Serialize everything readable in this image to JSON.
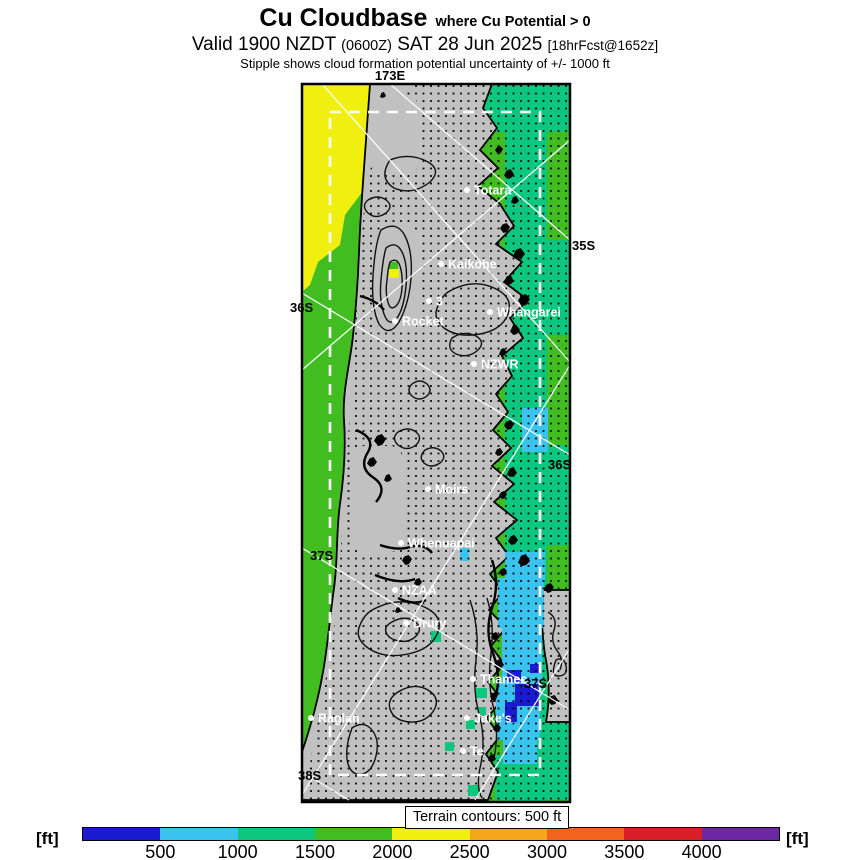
{
  "header": {
    "title": "Cu Cloudbase",
    "title_qualifier": "where Cu Potential > 0",
    "valid_prefix": "Valid 1900 NZDT",
    "valid_utc": "(0600Z)",
    "valid_date": "SAT 28 Jun 2025",
    "forecast_ref": "[18hrFcst@1652z]",
    "stipple_note": "Stipple shows cloud formation potential uncertainty of +/- 1000 ft"
  },
  "map": {
    "grid_labels": [
      {
        "text": "173E",
        "x": 390,
        "y": 80,
        "anchor": "middle"
      },
      {
        "text": "35S",
        "x": 572,
        "y": 250,
        "anchor": "start"
      },
      {
        "text": "36S",
        "x": 290,
        "y": 312,
        "anchor": "start"
      },
      {
        "text": "36S",
        "x": 548,
        "y": 469,
        "anchor": "start"
      },
      {
        "text": "37S",
        "x": 310,
        "y": 560,
        "anchor": "start"
      },
      {
        "text": "37S",
        "x": 524,
        "y": 688,
        "anchor": "start"
      },
      {
        "text": "38S",
        "x": 298,
        "y": 780,
        "anchor": "start"
      }
    ],
    "places": [
      {
        "name": "Totara",
        "x": 467,
        "y": 190
      },
      {
        "name": "Kaikohe",
        "x": 441,
        "y": 264
      },
      {
        "name": "3",
        "x": 429,
        "y": 301
      },
      {
        "name": "Rocket",
        "x": 395,
        "y": 321
      },
      {
        "name": "Whangarei",
        "x": 490,
        "y": 312
      },
      {
        "name": "NZWR",
        "x": 474,
        "y": 364
      },
      {
        "name": "Moirs",
        "x": 428,
        "y": 489
      },
      {
        "name": "Whenuapai",
        "x": 401,
        "y": 543
      },
      {
        "name": "NZAA",
        "x": 395,
        "y": 590
      },
      {
        "name": "Drury",
        "x": 406,
        "y": 623
      },
      {
        "name": "Thames",
        "x": 473,
        "y": 679
      },
      {
        "name": "Jake's",
        "x": 467,
        "y": 718
      },
      {
        "name": "Raglan",
        "x": 311,
        "y": 718
      },
      {
        "name": "Te",
        "x": 463,
        "y": 751
      }
    ]
  },
  "legend": {
    "terrain_note": "Terrain contours: 500 ft",
    "unit_left": "[ft]",
    "unit_right": "[ft]",
    "ticks": [
      "500",
      "1000",
      "1500",
      "2000",
      "2500",
      "3000",
      "3500",
      "4000"
    ],
    "segment_colors": [
      "#1a1ad1",
      "#3ac3ef",
      "#0cc87e",
      "#41bd22",
      "#f1ef10",
      "#f5a71b",
      "#f2641e",
      "#da1f28",
      "#6b28a2"
    ]
  },
  "palette": {
    "cloudbase_500": "#1a1ad1",
    "cloudbase_1000": "#3ac3ef",
    "cloudbase_1500": "#0cc87e",
    "cloudbase_2000": "#41bd22",
    "cloudbase_2500": "#f1ef10",
    "land": "#c1c1c1"
  }
}
